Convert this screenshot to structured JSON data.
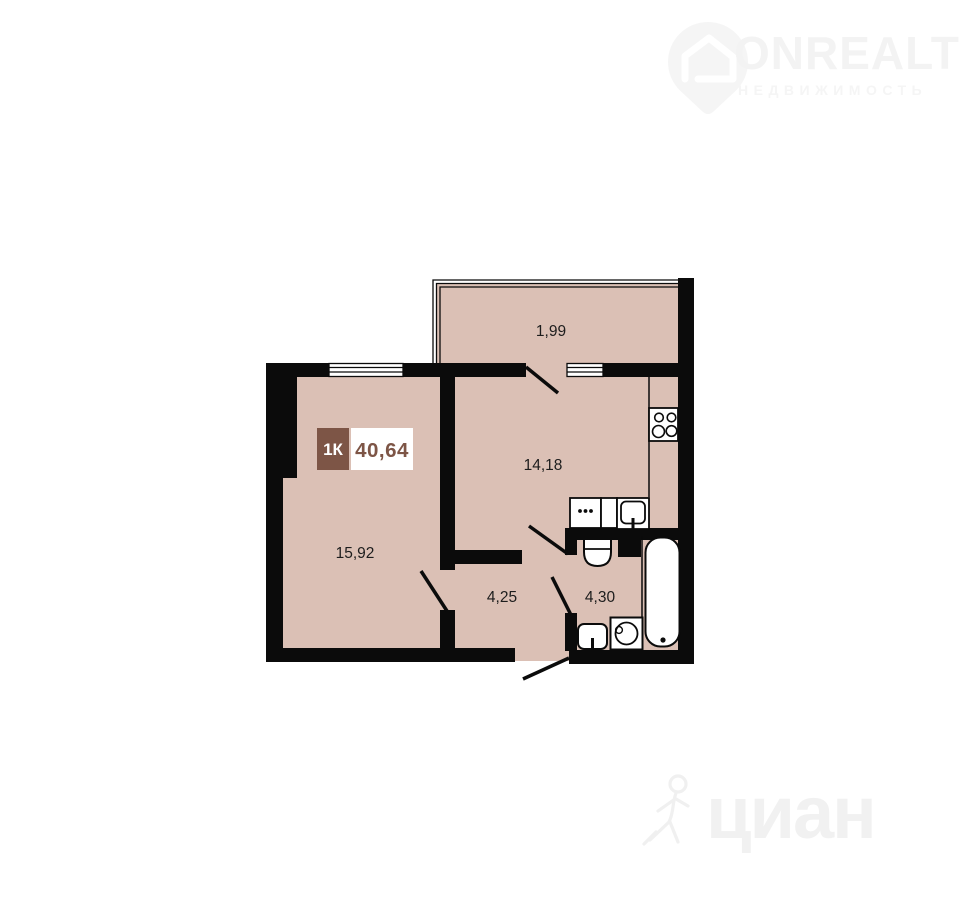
{
  "page": {
    "background": "#ffffff",
    "width": 960,
    "height": 910
  },
  "watermarks": {
    "onrealt": {
      "brand": "ONREALT",
      "subtitle": "НЕДВИЖИМОСТЬ",
      "icon": "map-pin-house-icon",
      "color": "#f3f3f3"
    },
    "cian": {
      "brand": "циан",
      "icon": "walking-person-icon",
      "color": "#f1f1f1"
    }
  },
  "plan": {
    "badge": {
      "type": "1К",
      "area": "40,64",
      "badge_bg": "#7d5546",
      "badge_text_color": "#ffffff",
      "area_bg": "#ffffff",
      "area_text_color": "#7d5546"
    },
    "rooms": {
      "balcony": {
        "area": "1,99"
      },
      "kitchen": {
        "area": "14,18"
      },
      "living": {
        "area": "15,92"
      },
      "hallway": {
        "area": "4,25"
      },
      "bathroom": {
        "area": "4,30"
      }
    },
    "colors": {
      "floor": "#dbc0b5",
      "wall": "#0b0b0b",
      "label_text": "#1d1d1d",
      "fixture_fill": "#ffffff"
    },
    "fixtures": [
      "stove-icon",
      "counter-dots-icon",
      "kitchen-sink-icon",
      "toilet-icon",
      "bathtub-icon",
      "washbasin-icon",
      "washing-machine-icon"
    ]
  }
}
